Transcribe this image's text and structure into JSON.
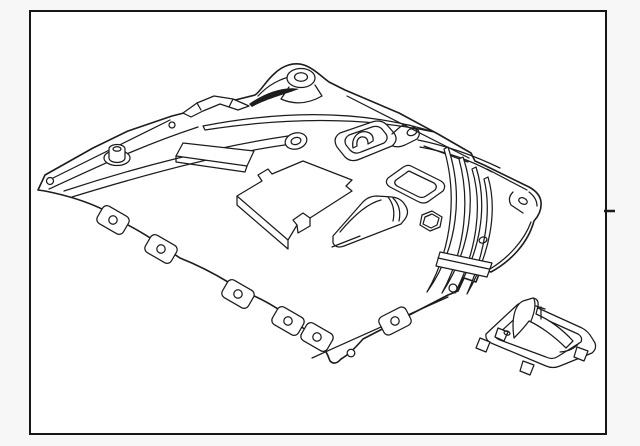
{
  "page": {
    "background": "#f7f7f7"
  },
  "frame": {
    "background": "#ffffff",
    "border_color": "#161616"
  },
  "illustration": {
    "line_color": "#1c1c1c",
    "main_part": "engine-splash-shield",
    "secondary_part": "mounting-bracket"
  }
}
